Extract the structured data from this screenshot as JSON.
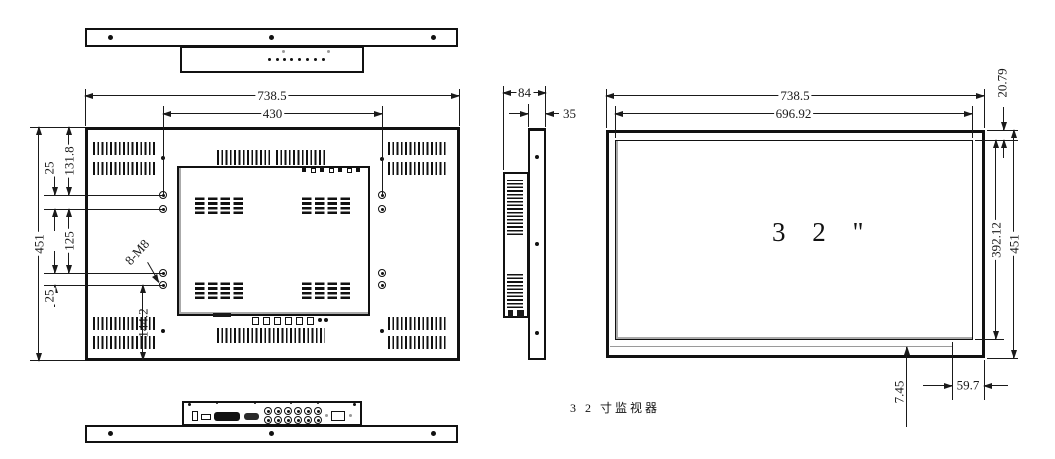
{
  "drawing": {
    "caption": "3 2 寸监视器",
    "screen_size_label": "3 2 \"",
    "line_color": "#1a1a1a",
    "accent_gray": "#9a9a9a"
  },
  "back_view": {
    "width": "738.5",
    "mount_width": "430",
    "height": "451",
    "hole_top_offset": "131.8",
    "hole_gap_top": "25",
    "hole_mid_span": "125",
    "hole_gap_bottom": "25",
    "hole_bottom_offset": "144.2",
    "thread_label": "8-M8"
  },
  "side_view": {
    "total_depth": "84",
    "front_depth": "35"
  },
  "front_view": {
    "width": "738.5",
    "screen_width": "696.92",
    "top_margin": "20.79",
    "screen_height": "392.12",
    "height": "451",
    "bottom_margin": "7.45",
    "corner_offset": "59.7"
  }
}
